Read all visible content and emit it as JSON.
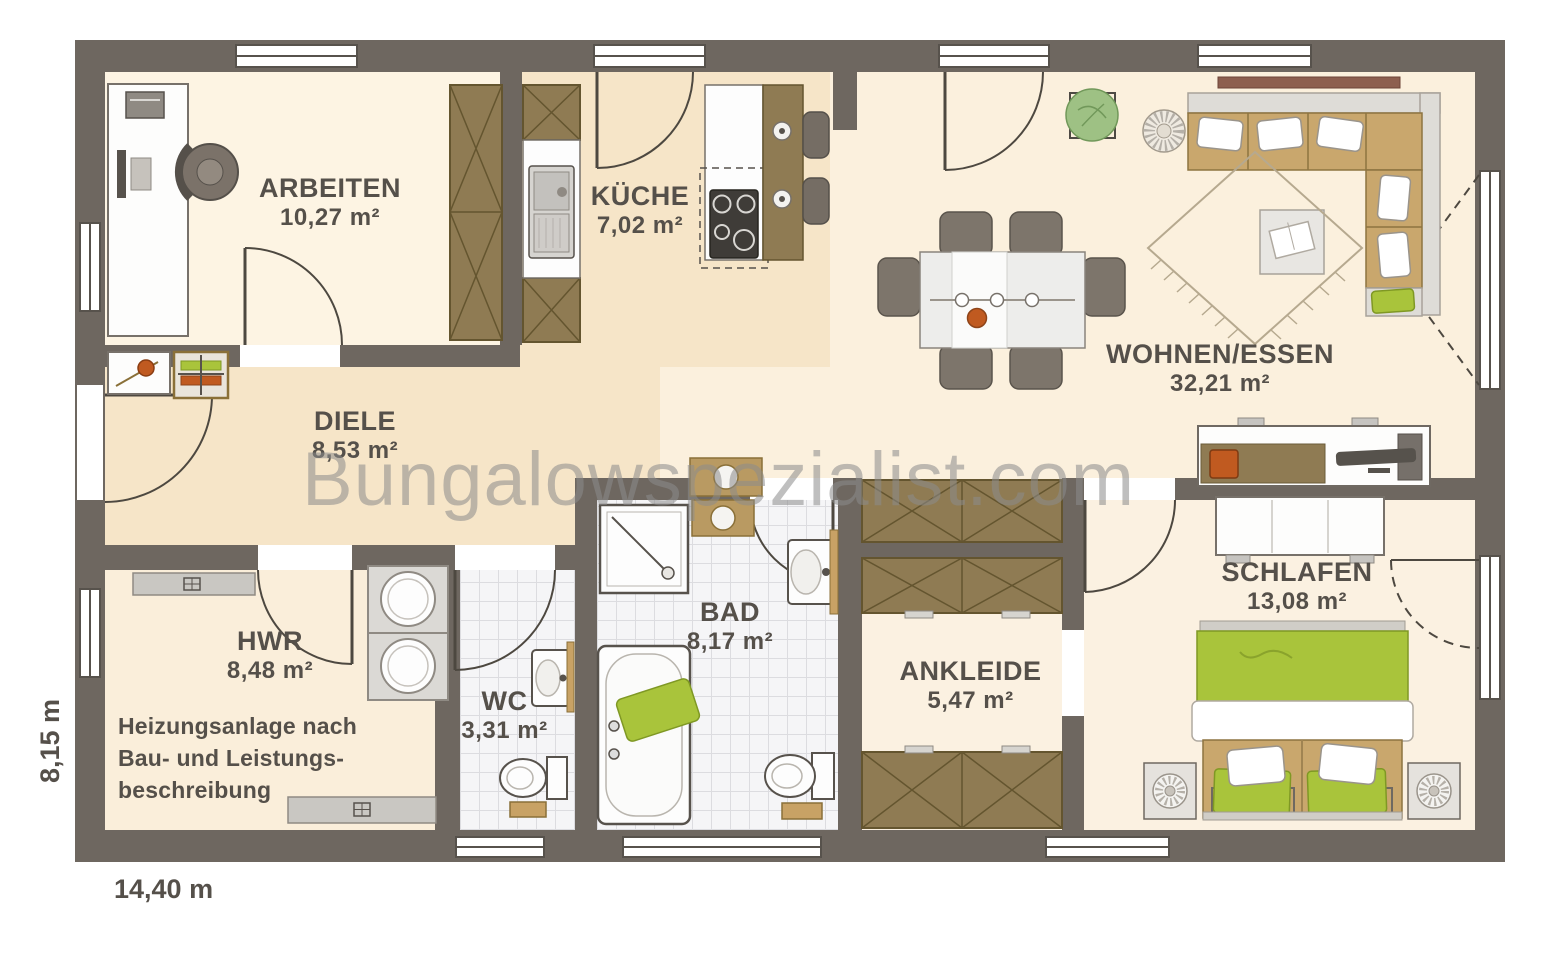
{
  "watermark": {
    "text": "Bungalowspezialist.com"
  },
  "dimensions": {
    "width": "14,40 m",
    "height": "8,15 m"
  },
  "rooms": [
    {
      "id": "arbeiten",
      "name": "ARBEITEN",
      "area": "10,27 m²"
    },
    {
      "id": "kueche",
      "name": "KÜCHE",
      "area": "7,02 m²"
    },
    {
      "id": "wohnen-essen",
      "name": "WOHNEN/ESSEN",
      "area": "32,21 m²"
    },
    {
      "id": "diele",
      "name": "DIELE",
      "area": "8,53 m²"
    },
    {
      "id": "hwr",
      "name": "HWR",
      "area": "8,48 m²"
    },
    {
      "id": "wc",
      "name": "WC",
      "area": "3,31 m²"
    },
    {
      "id": "bad",
      "name": "BAD",
      "area": "8,17 m²"
    },
    {
      "id": "ankleide",
      "name": "ANKLEIDE",
      "area": "5,47 m²"
    },
    {
      "id": "schlafen",
      "name": "SCHLAFEN",
      "area": "13,08 m²"
    }
  ],
  "annotations": {
    "hwr_note": "Heizungsanlage nach\nBau- und Leistungs-\nbeschreibung"
  },
  "colors": {
    "wall": "#6e6760",
    "frame": "#57524c",
    "cream": "#fbf0dd",
    "beige": "#f6e5c8",
    "creamlight": "#fdf4e3",
    "cream2": "#faeeda",
    "cream3": "#fbf1e1",
    "tiles": "#f5f5f7",
    "tileline": "#dcdce0",
    "wood": "#8f7b53",
    "wooddark": "#64552f",
    "tan": "#c9a76d",
    "green": "#a9c43b",
    "orange": "#c05a20",
    "label": "#55504a",
    "watermark": "#8c8c8c"
  }
}
